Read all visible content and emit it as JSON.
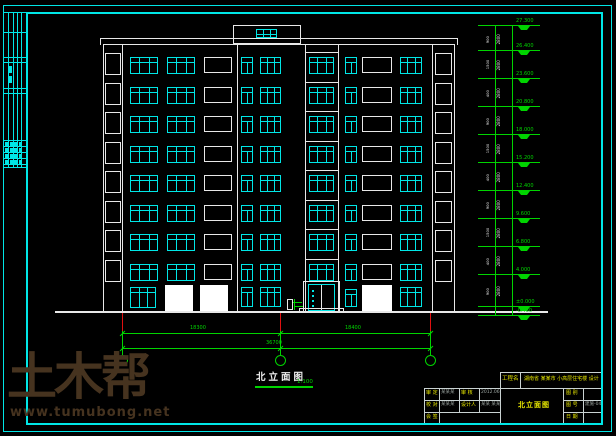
{
  "colors": {
    "line_white": "#e8e8e8",
    "line_cyan": "#00e6e6",
    "line_green": "#00d400",
    "accent_red": "#e01010",
    "text_yellow": "#e8e800",
    "watermark_brown": "#46331f"
  },
  "watermark": {
    "logo": "土木帮",
    "url": "www.tumubong.net"
  },
  "drawing": {
    "title": "北立面图",
    "scale": "1:100"
  },
  "dimensions": {
    "segment_left": "18300",
    "segment_right": "18400",
    "total": "36700"
  },
  "building": {
    "floors": 8,
    "has_penthouse": true,
    "entrance": "双扇玻璃门"
  },
  "right_strip": {
    "marks": [
      {
        "label": "27.300",
        "y": 25
      },
      {
        "label": "26.400",
        "y": 50
      },
      {
        "label": "23.600",
        "y": 78
      },
      {
        "label": "20.800",
        "y": 106
      },
      {
        "label": "18.000",
        "y": 134
      },
      {
        "label": "15.200",
        "y": 162
      },
      {
        "label": "12.400",
        "y": 190
      },
      {
        "label": "9.600",
        "y": 218
      },
      {
        "label": "6.800",
        "y": 246
      },
      {
        "label": "4.000",
        "y": 274
      },
      {
        "label": "±0.000",
        "y": 306
      },
      {
        "label": "-0.450",
        "y": 315
      }
    ],
    "floor_dim_main": "2800",
    "floor_dims_small": [
      "900",
      "1500",
      "400"
    ]
  },
  "title_block": {
    "project_label": "工程名",
    "project_name": "湖南省 某某市 小高层住宅楼 设计",
    "drawing_name": "北立面图",
    "left_rows": [
      [
        "审 定",
        "某某某",
        "审 核",
        "2012.06"
      ],
      [
        "校 对",
        "某某某",
        "设计人",
        "某某 某某"
      ],
      [
        "会 签",
        "",
        "",
        ""
      ]
    ],
    "right_rows": [
      [
        "图 别",
        ""
      ],
      [
        "图 号",
        "建施-04"
      ],
      [
        "日 期",
        ""
      ]
    ]
  }
}
